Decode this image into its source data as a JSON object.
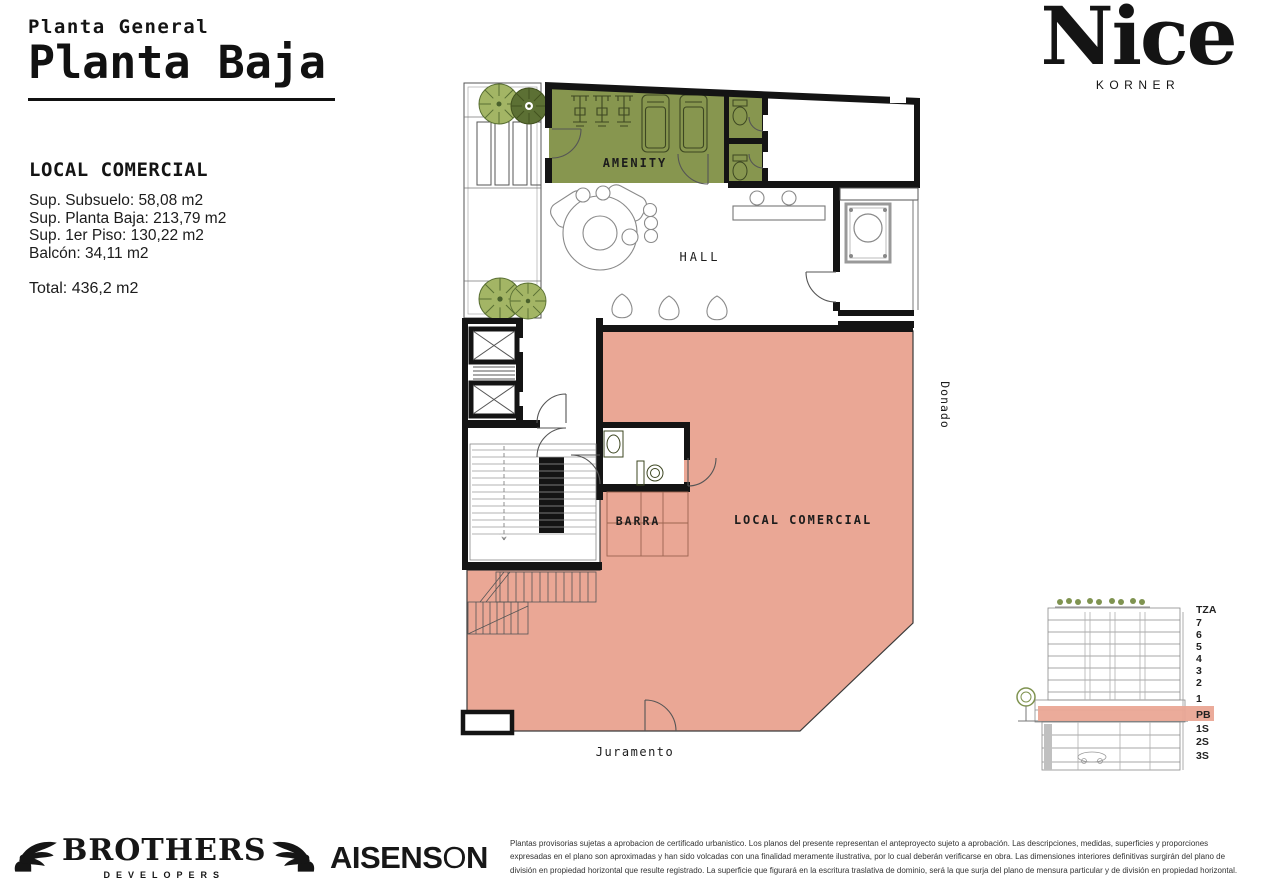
{
  "header": {
    "supertitle": "Planta General",
    "title": "Planta Baja"
  },
  "info": {
    "heading": "LOCAL COMERCIAL",
    "lines": [
      "Sup. Subsuelo: 58,08 m2",
      "Sup. Planta Baja: 213,79 m2",
      "Sup. 1er Piso: 130,22 m2",
      "Balcón: 34,11 m2"
    ],
    "total": "Total: 436,2 m2"
  },
  "brand": {
    "name": "Nice",
    "sub": "KORNER"
  },
  "plan": {
    "rooms": {
      "amenity": "AMENITY",
      "hall": "HALL",
      "barra": "BARRA",
      "local": "LOCAL COMERCIAL"
    },
    "streets": {
      "bottom": "Juramento",
      "right": "Donado"
    }
  },
  "section": {
    "floors": [
      "TZA",
      "7",
      "6",
      "5",
      "4",
      "3",
      "2",
      "1",
      "PB",
      "1S",
      "2S",
      "3S"
    ],
    "highlighted": "PB"
  },
  "footer": {
    "brothers": {
      "name": "BROTHERS",
      "sub": "DEVELOPERS"
    },
    "aisenson": {
      "p1": "AISENS",
      "o": "O",
      "p2": "N"
    },
    "disclaimer": "Plantas provisorias sujetas a aprobacion de certificado urbanistico. Los planos del presente representan el anteproyecto sujeto a aprobación. Las descripciones, medidas, superficies y proporciones expresadas en el plano son aproximadas y han sido volcadas con una finalidad meramente ilustrativa, por lo cual deberán verificarse en obra. Las dimensiones interiores definitivas surgirán del plano de división en propiedad horizontal que resulte registrado. La superficie que figurará en la escritura traslativa de dominio, será la que surja del plano de mensura particular y de división en propiedad horizontal."
  },
  "colors": {
    "amenity_green": "#87964F",
    "local_pink": "#EAA795",
    "wall_black": "#141414"
  }
}
